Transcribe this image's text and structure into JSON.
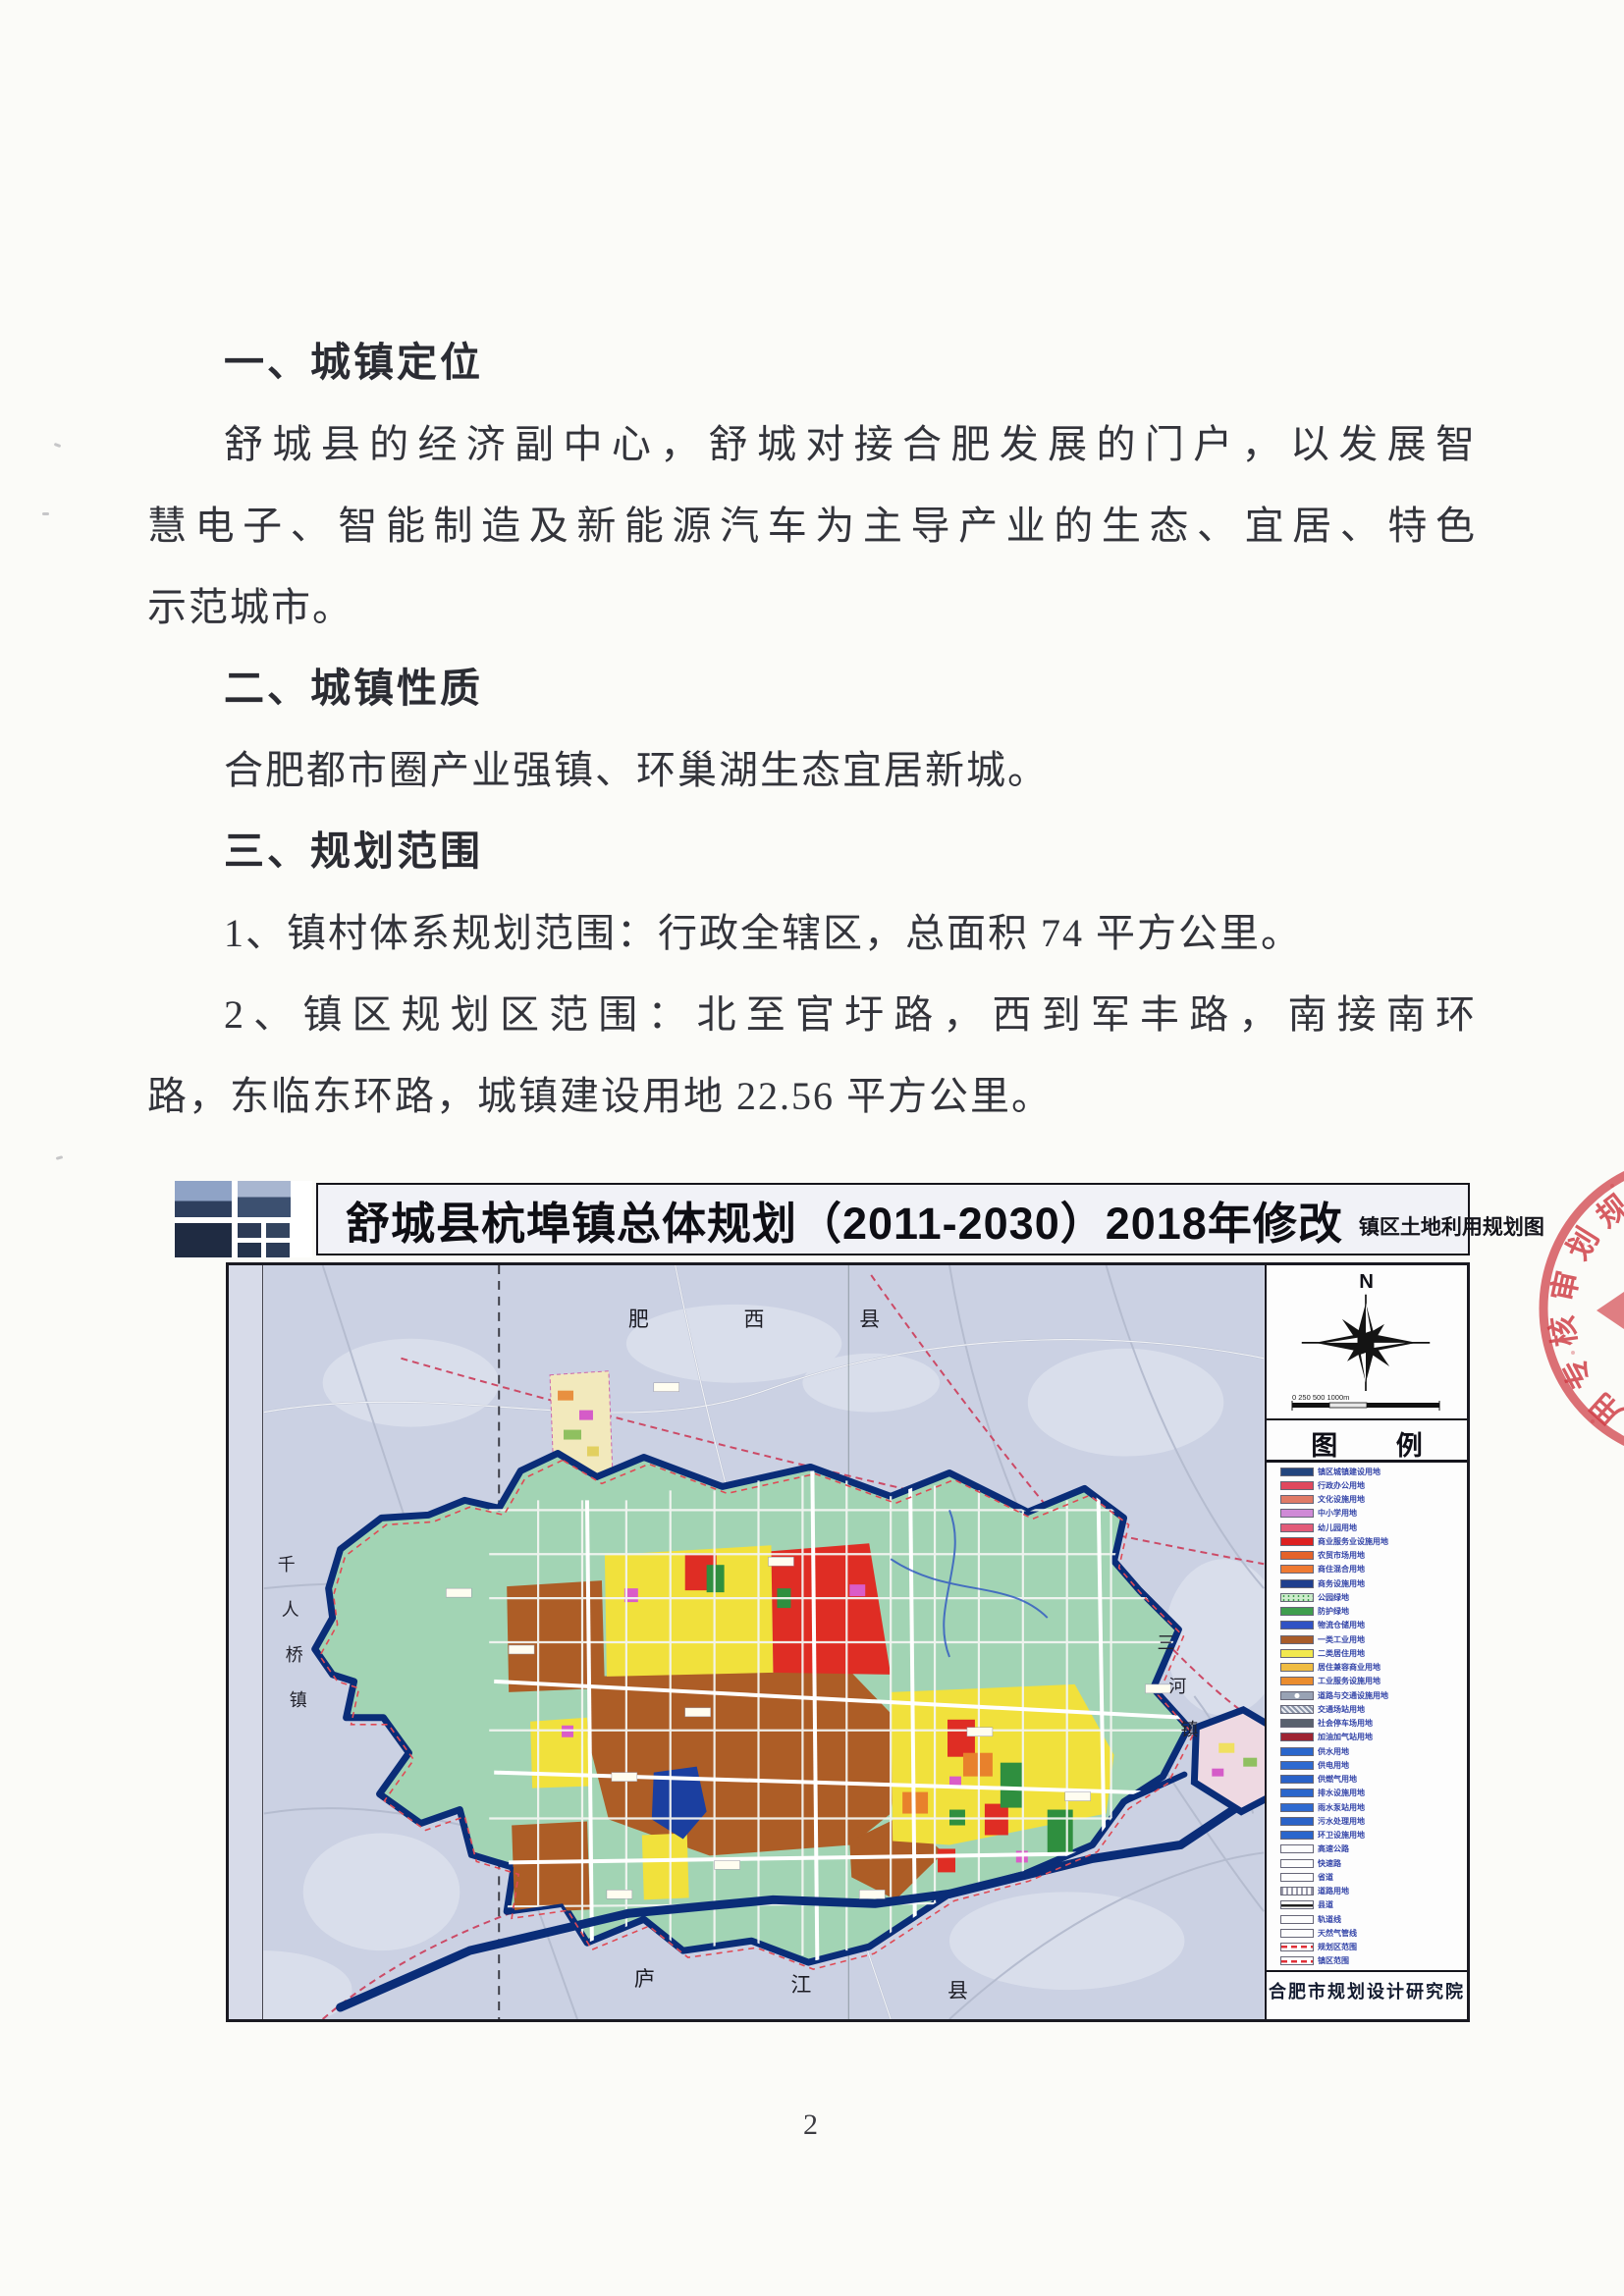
{
  "page": {
    "number": "2"
  },
  "document": {
    "lines": [
      {
        "t": "一、城镇定位",
        "c": "h"
      },
      {
        "t": "舒城县的经济副中心，舒城对接合肥发展的门户，以发展智",
        "c": "bif"
      },
      {
        "t": "慧电子、智能制造及新能源汽车为主导产业的生态、宜居、特色",
        "c": "bf"
      },
      {
        "t": "示范城市。",
        "c": "b"
      },
      {
        "t": "二、城镇性质",
        "c": "h"
      },
      {
        "t": "合肥都市圈产业强镇、环巢湖生态宜居新城。",
        "c": "bi"
      },
      {
        "t": "三、规划范围",
        "c": "h"
      },
      {
        "t": "1、镇村体系规划范围：行政全辖区，总面积 74 平方公里。",
        "c": "bi"
      },
      {
        "t": "2、镇区规划区范围：北至官圩路，西到军丰路，南接南环",
        "c": "bif"
      },
      {
        "t": "路，东临东环路，城镇建设用地 22.56 平方公里。",
        "c": "b"
      }
    ]
  },
  "map": {
    "title": "舒城县杭埠镇总体规划（2011-2030）2018年修改",
    "subtitle": "镇区土地利用规划图",
    "compass_label": "N",
    "scale_text": "0  250  500        1000m",
    "legend_title": "图  例",
    "publisher": "合肥市规划设计研究院",
    "region_chars": {
      "top": [
        "肥",
        "西",
        "县"
      ],
      "bottom": [
        "庐",
        "江",
        "县"
      ],
      "right": [
        "三",
        "河",
        "镇"
      ],
      "left": [
        "千",
        "人",
        "桥",
        "镇"
      ]
    },
    "colors": {
      "water_border": "#0a2d78",
      "plan_area_green": "#a2d4b4",
      "industry_brown": "#ad5d26",
      "residential_yellow": "#f1e13c",
      "commercial_red": "#df2d24",
      "outer_background": "#cbd1e3",
      "boundary_red_dash": "#d84a55"
    },
    "legend_items": [
      {
        "color": "#23457e",
        "type": "solid",
        "label": "镇区城镇建设用地"
      },
      {
        "color": "#e0485e",
        "type": "solid",
        "label": "行政办公用地"
      },
      {
        "color": "#e07a66",
        "type": "solid",
        "label": "文化设施用地"
      },
      {
        "color": "#cf8ad6",
        "type": "solid",
        "label": "中小学用地"
      },
      {
        "color": "#e25b79",
        "type": "solid",
        "label": "幼儿园用地"
      },
      {
        "color": "#dd2020",
        "type": "solid",
        "label": "商业服务业设施用地"
      },
      {
        "color": "#e4622a",
        "type": "solid",
        "label": "农贸市场用地"
      },
      {
        "color": "#ef7a32",
        "type": "solid",
        "label": "商住混合用地"
      },
      {
        "color": "#1f3f8e",
        "type": "solid",
        "label": "商务设施用地"
      },
      {
        "color": "#cdeccc",
        "type": "dots",
        "label": "公园绿地"
      },
      {
        "color": "#3f9e4e",
        "type": "solid",
        "label": "防护绿地"
      },
      {
        "color": "#3052c4",
        "type": "solid",
        "label": "物流仓储用地"
      },
      {
        "color": "#a85c2a",
        "type": "solid",
        "label": "一类工业用地"
      },
      {
        "color": "#f2e84e",
        "type": "solid",
        "label": "二类居住用地"
      },
      {
        "color": "#f0bc42",
        "type": "solid",
        "label": "居住兼容商业用地"
      },
      {
        "color": "#ea8c2e",
        "type": "solid",
        "label": "工业服务设施用地"
      },
      {
        "color": "#98a2b4",
        "type": "circle",
        "label": "道路与交通设施用地"
      },
      {
        "color": "#8892a6",
        "type": "hatch",
        "label": "交通场站用地"
      },
      {
        "color": "#59616e",
        "type": "solid",
        "label": "社会停车场用地"
      },
      {
        "color": "#9e2433",
        "type": "solid",
        "label": "加油加气站用地"
      },
      {
        "color": "#2a66cc",
        "type": "solid",
        "label": "供水用地"
      },
      {
        "color": "#2e6ad0",
        "type": "solid",
        "label": "供电用地"
      },
      {
        "color": "#2a62c8",
        "type": "solid",
        "label": "供燃气用地"
      },
      {
        "color": "#2a66cc",
        "type": "solid",
        "label": "排水设施用地"
      },
      {
        "color": "#2e6ad0",
        "type": "solid",
        "label": "雨水泵站用地"
      },
      {
        "color": "#2a62c8",
        "type": "solid",
        "label": "污水处理用地"
      },
      {
        "color": "#2a66cc",
        "type": "solid",
        "label": "环卫设施用地"
      },
      {
        "color": "#ffffff",
        "type": "outline",
        "label": "高速公路"
      },
      {
        "color": "#ffffff",
        "type": "outline",
        "label": "快速路"
      },
      {
        "color": "#ffffff",
        "type": "outline",
        "label": "省道"
      },
      {
        "color": "#ffffff",
        "type": "hatch2",
        "label": "道路用地"
      },
      {
        "color": "#ffffff",
        "type": "line",
        "label": "县道"
      },
      {
        "color": "#ffffff",
        "type": "outline",
        "label": "轨道线"
      },
      {
        "color": "#ffffff",
        "type": "outline",
        "label": "天然气管线"
      },
      {
        "color": "#e03038",
        "type": "reddash",
        "label": "规划区范围"
      },
      {
        "color": "#e03038",
        "type": "reddash",
        "label": "镇区范围"
      }
    ]
  },
  "stamp": {
    "chars": [
      "规",
      "划",
      "审",
      "核",
      "专",
      "用"
    ]
  }
}
